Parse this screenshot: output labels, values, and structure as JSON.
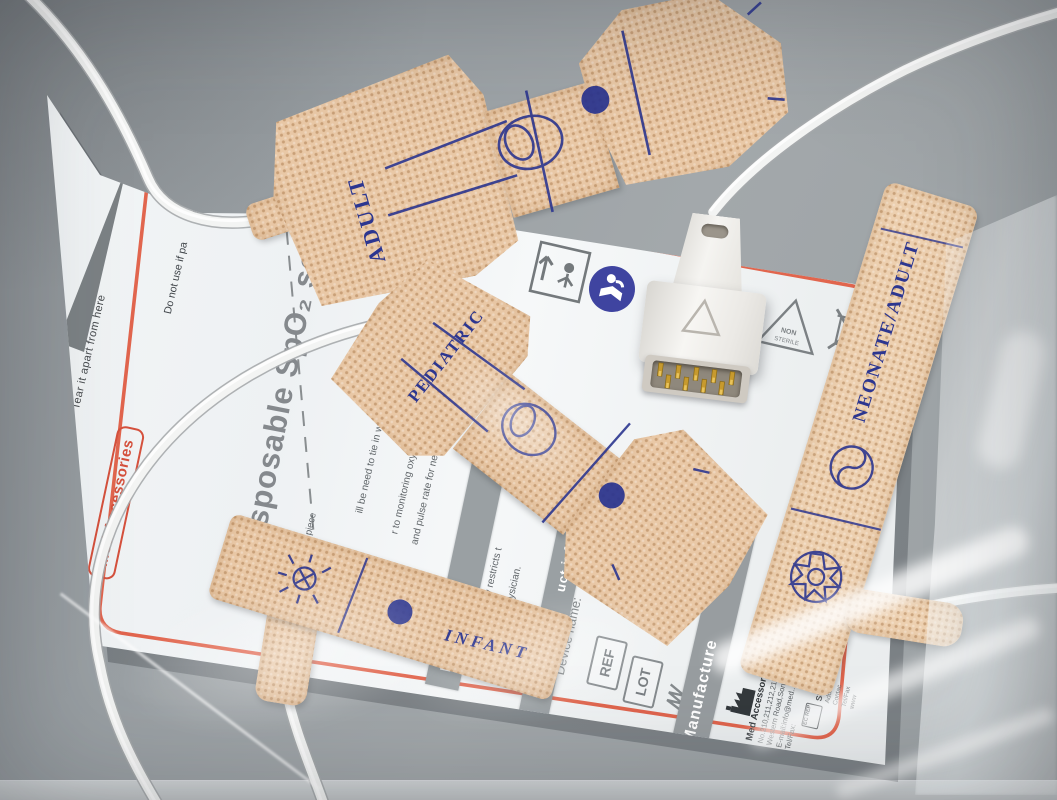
{
  "photo": {
    "subject": "Disposable SpO2 sensor set with packaging pouch"
  },
  "package": {
    "title": "Disposable SpO₂ sensor",
    "brand": "Med Accessories",
    "tear_label": "Tear it apart from here",
    "warning_fragment_1": "Do not use if pa",
    "warning_fragment_2": "s damaged",
    "piece_fragment": "piece",
    "instruction_fragments": [
      "ill be need to tie in wi",
      "r to monitoring oxy",
      "and pulse rate for ne",
      "er or"
    ],
    "caution_band_fragment": "ION",
    "caution_fragments": [
      "(U.S.) Law restricts t",
      "er of a physician."
    ],
    "info_band_fragment": "uct informa",
    "device_name_label": "Device name:",
    "manufacture_band": "Manufacture",
    "manufacturer_name": "Med Accessories Technology DongGuan Co.,Ltd.",
    "manufacturer_lines": [
      "No.210,211,212,213, Building 1,No.12 Industry",
      "Western Road,Son..,Dongguan,Guangdong,China.",
      "E-mail:info@med....com",
      "Tel/Fax:"
    ],
    "distributor_name": "SUNG",
    "distributor_lines": [
      "Add:",
      "Contac",
      "Tel/Fax",
      "www"
    ],
    "symbols": {
      "ref": "REF",
      "lot": "LOT",
      "ec_rep": "EC REP",
      "non_sterile_1": "NON",
      "non_sterile_2": "STERILE"
    }
  },
  "sensors": {
    "adult_label": "ADULT",
    "pediatric_label": "PEDIATRIC",
    "infant_label": "INFANT",
    "neonate_label": "NEONATE/ADULT"
  },
  "colors": {
    "fabric": "#e9c8a6",
    "ink_blue": "#2c3690",
    "accent_red": "#e2604a",
    "pouch_paper": "#f2f5f6",
    "surface_gray": "#9ea3a7"
  }
}
